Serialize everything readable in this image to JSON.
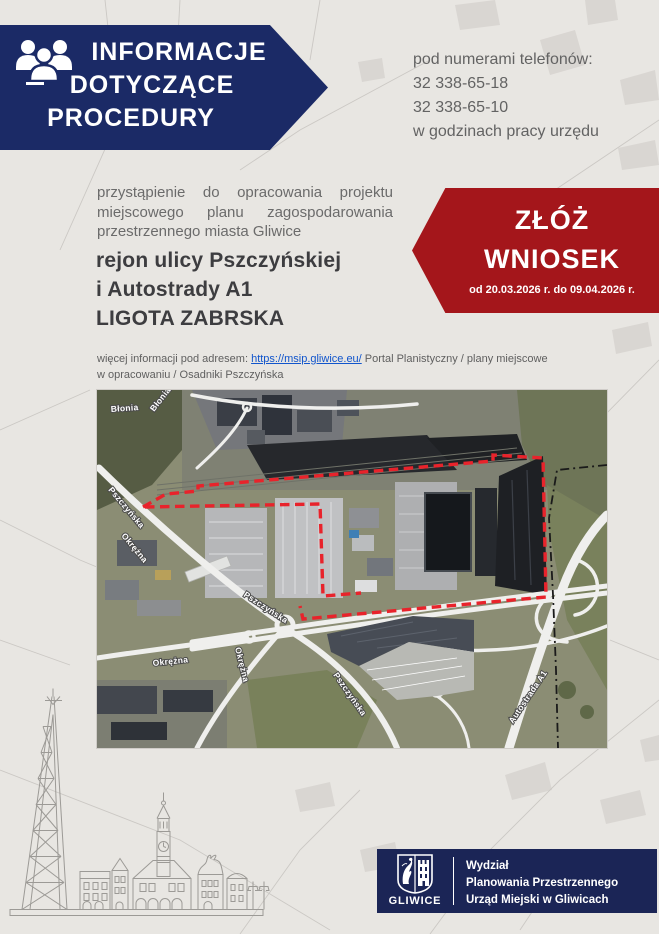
{
  "banner": {
    "title_lines": [
      "INFORMACJE",
      "DOTYCZĄCE",
      "PROCEDURY"
    ]
  },
  "contact": {
    "intro": "pod numerami telefonów:",
    "phone1": "32 338-65-18",
    "phone2": "32 338-65-10",
    "hours": "w godzinach pracy urzędu"
  },
  "intro": {
    "line1": "przystąpienie do opracowania projektu",
    "line2": "miejscowego planu zagospodarowania",
    "line3": "przestrzennego miasta Gliwice"
  },
  "heading": {
    "line1": "rejon ulicy Pszczyńskiej",
    "line2": "i Autostrady A1",
    "line3": "LIGOTA ZABRSKA"
  },
  "cta": {
    "word1": "ZŁÓŻ",
    "word2": "WNIOSEK",
    "dates": "od 20.03.2026 r. do 09.04.2026 r."
  },
  "more_info": {
    "prefix": "więcej informacji pod adresem: ",
    "link": "https://msip.gliwice.eu/",
    "suffix": " Portal Planistyczny / plany miejscowe",
    "line2": "w opracowaniu / Osadniki Pszczyńska"
  },
  "map": {
    "street_labels": [
      "Błonia",
      "Błonia",
      "Pszczyńska",
      "Okrężna",
      "Pszczyńska",
      "Okrężna",
      "Okrężna",
      "Pszczyńska",
      "Autostrada A1"
    ],
    "boundary_color": "#e8232b"
  },
  "footer": {
    "logo_text": "GLIWICE",
    "dept_line1": "Wydział",
    "dept_line2": "Planowania Przestrzennego",
    "dept_line3": "Urząd Miejski w Gliwicach"
  },
  "colors": {
    "navy_banner": "#1b2a66",
    "navy_footer": "#1b2556",
    "red": "#a4161b",
    "background": "#e8e6e2",
    "link_blue": "#1155cc"
  }
}
